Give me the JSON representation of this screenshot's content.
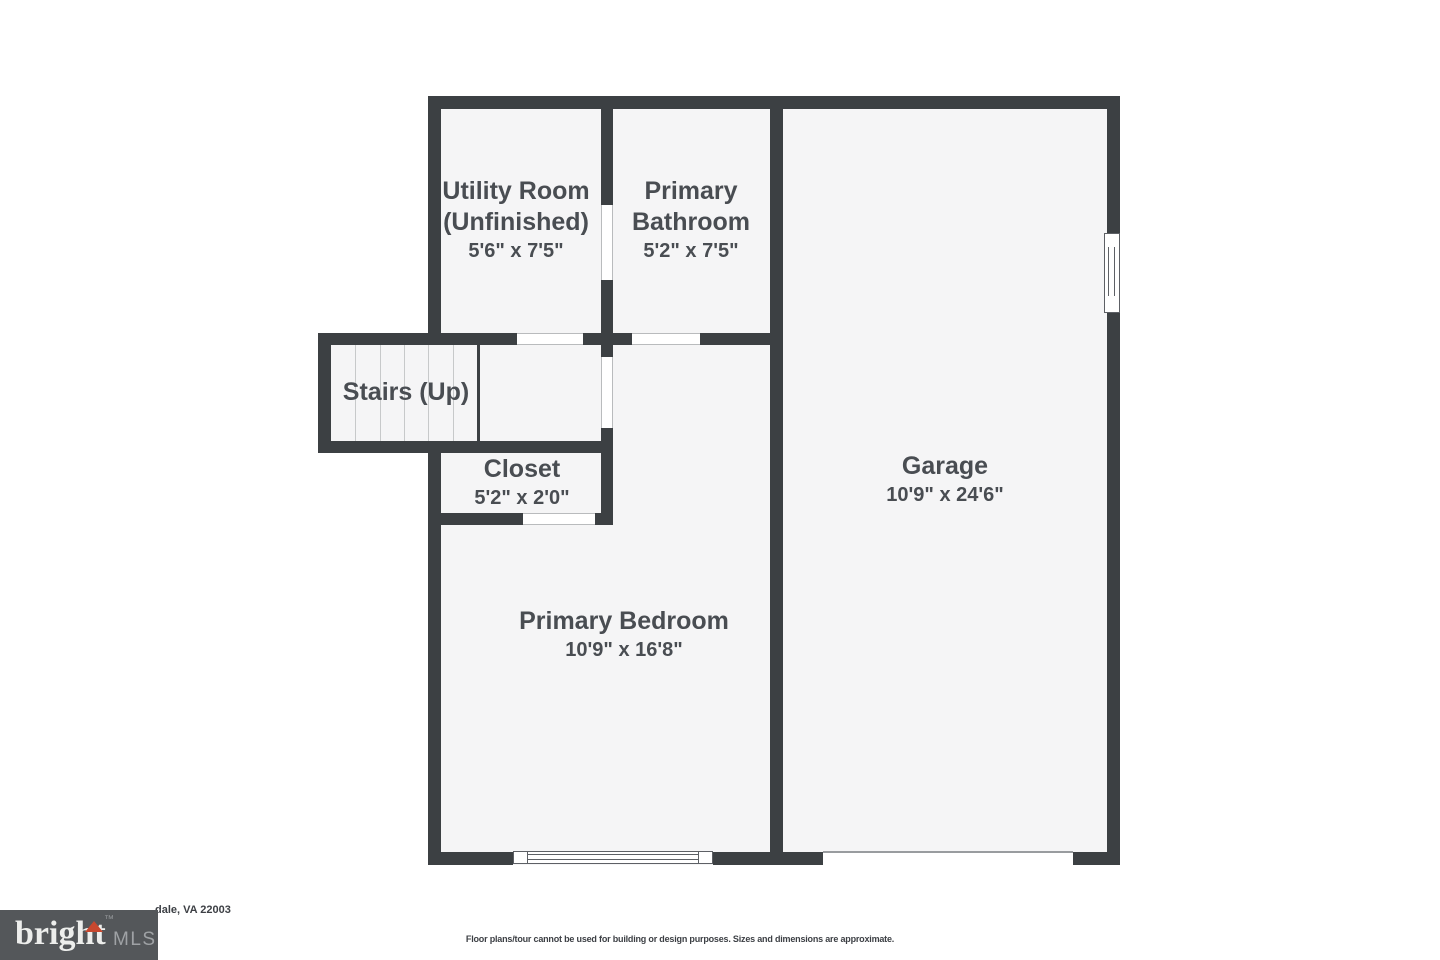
{
  "plan": {
    "rooms": {
      "utility": {
        "line1": "Utility Room",
        "line2": "(Unfinished)",
        "dims": "5'6\" x 7'5\""
      },
      "bathroom": {
        "line1": "Primary",
        "line2": "Bathroom",
        "dims": "5'2\" x 7'5\""
      },
      "stairs": {
        "line1": "Stairs (Up)"
      },
      "closet": {
        "line1": "Closet",
        "dims": "5'2\" x 2'0\""
      },
      "bedroom": {
        "line1": "Primary Bedroom",
        "dims": "10'9\" x 16'8\""
      },
      "garage": {
        "line1": "Garage",
        "dims": "10'9\" x 24'6\""
      }
    },
    "colors": {
      "wall": "#3c4043",
      "room_fill": "#f5f5f6",
      "label_text": "#494d52",
      "gap_edge": "#b9bbbd"
    }
  },
  "footer": {
    "address_visible": "dale, VA 22003",
    "disclaimer": "Floor plans/tour cannot be used for building or design purposes. Sizes and dimensions are approximate.",
    "logo": {
      "brand": "bright",
      "tm": "™",
      "suffix": "MLS",
      "bg": "#54575a",
      "triangle_color": "#c7482f"
    }
  }
}
